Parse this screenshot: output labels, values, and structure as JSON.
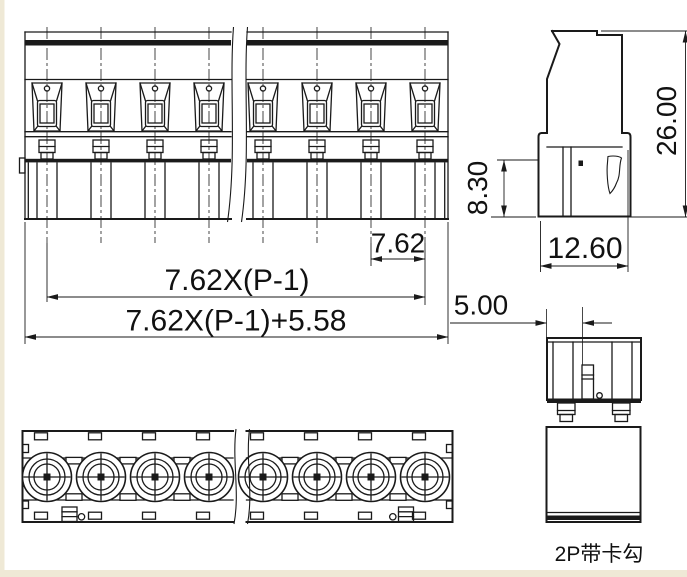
{
  "drawing": {
    "product_label": "2P带卡勾",
    "dimensions": {
      "pole_pitch": "7.62",
      "pitch_span_formula": "7.62X(P-1)",
      "overall_length_formula": "7.62X(P-1)+5.58",
      "latch_center_offset": "5.00",
      "plug_depth": "8.30",
      "overall_height": "26.00",
      "body_width": "12.60"
    },
    "colors": {
      "line": "#1a1a1a",
      "background": "#ffffff",
      "page_margin": "#efe9d6"
    }
  }
}
